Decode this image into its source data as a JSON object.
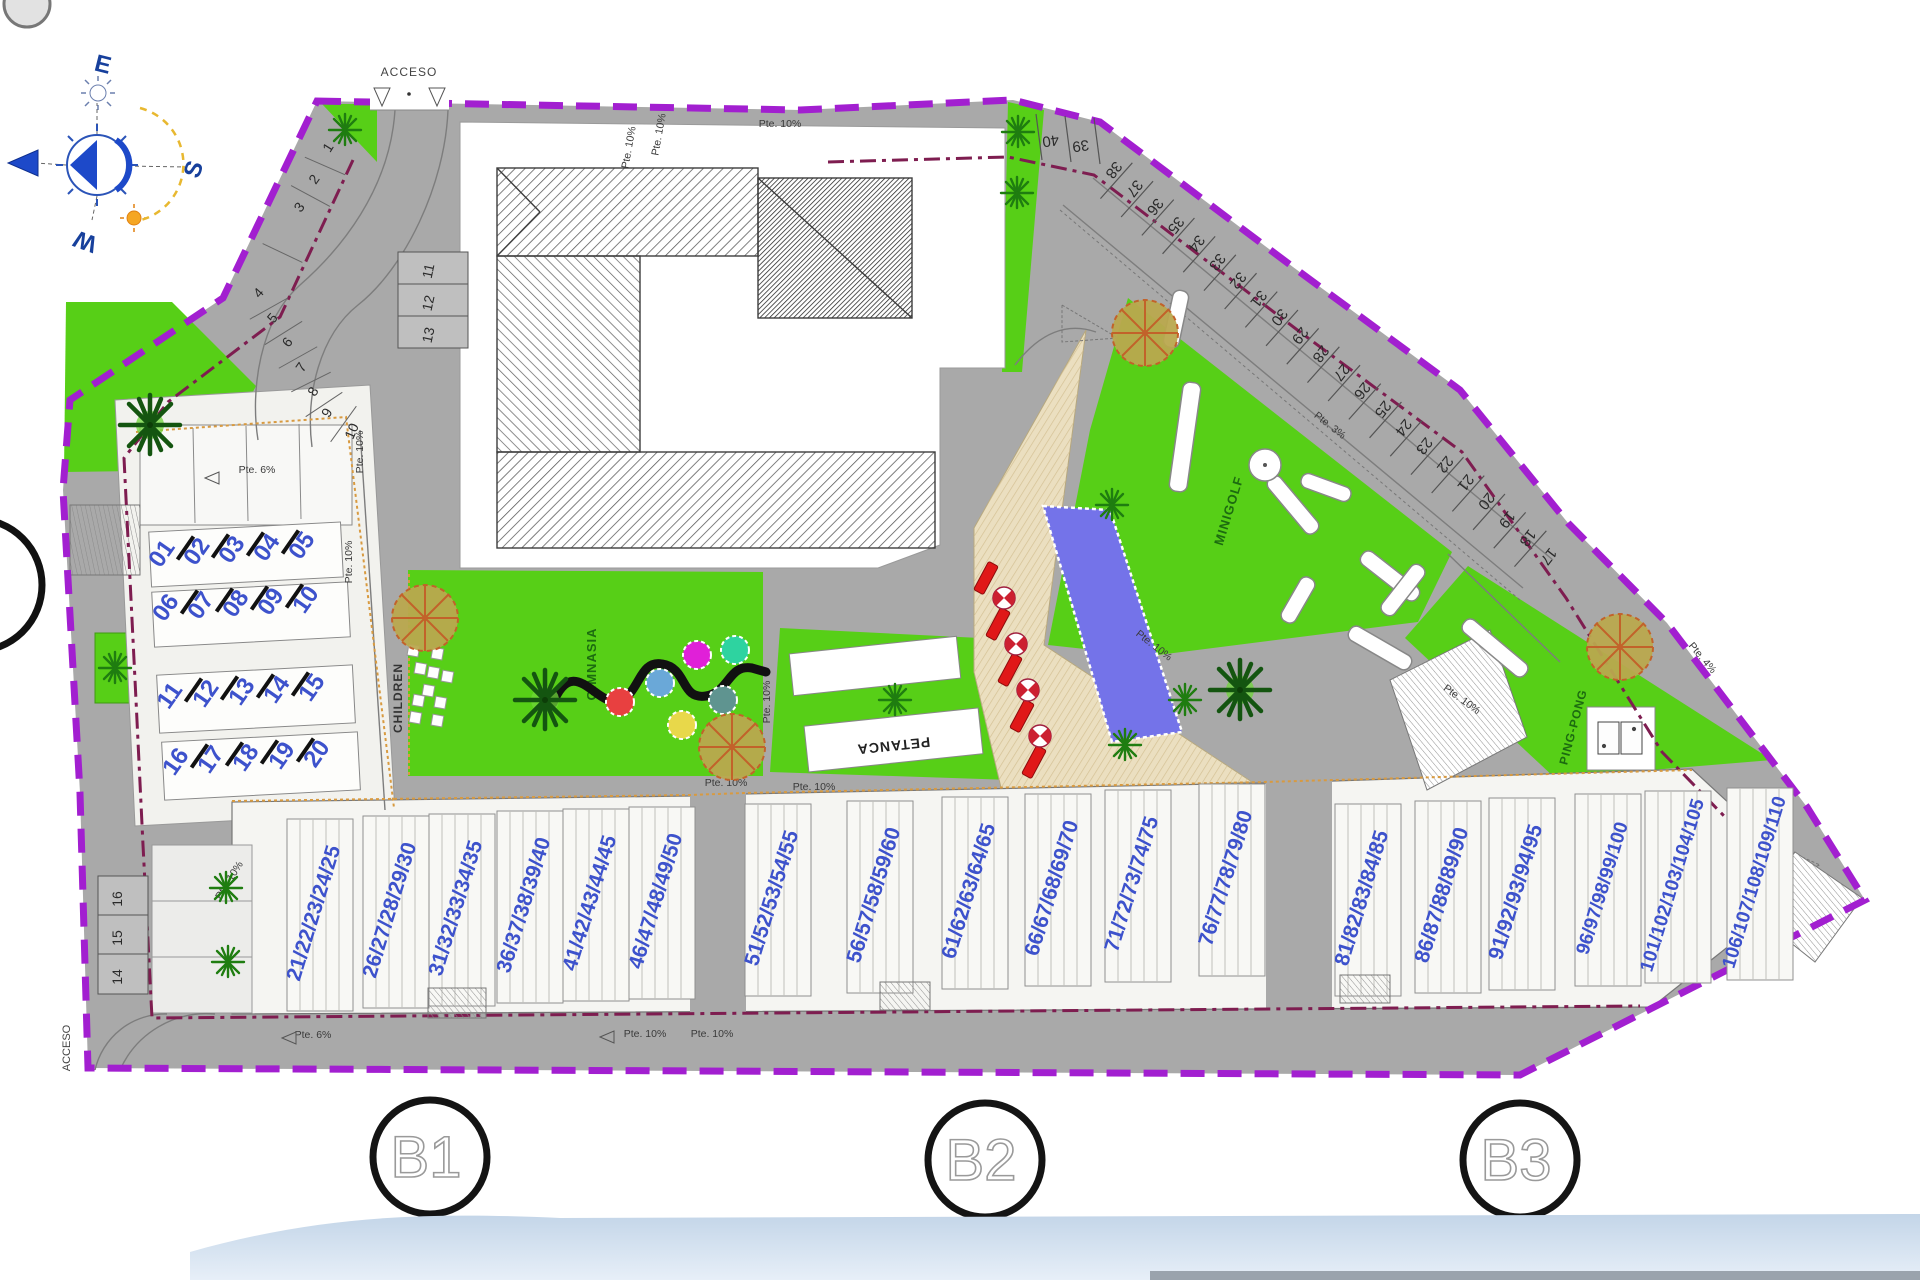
{
  "plan": {
    "access_top": "ACCESO",
    "access_bottom": "ACCESO",
    "compass": {
      "e": "E",
      "s": "S",
      "w": "W"
    },
    "areas": {
      "gym": "GIMNASIA",
      "children": "CHILDREN",
      "petanca": "PETANCA",
      "minigolf": "MINIGOLF",
      "pingpong": "PING-PONG"
    },
    "slopes": {
      "pte10": "Pte. 10%",
      "pte6": "Pte. 6%",
      "pte3": "Pte. 3%",
      "pte4": "Pte. 4%"
    },
    "sections": [
      "B1",
      "B2",
      "B3"
    ],
    "parking": {
      "left_curve": [
        "1",
        "2",
        "3",
        "4",
        "5",
        "6",
        "7",
        "8",
        "9",
        "10"
      ],
      "mid_block": [
        "11",
        "12",
        "13"
      ],
      "left_lower": [
        "16",
        "15",
        "14"
      ],
      "diagonal_top_to_bottom": [
        "38",
        "37",
        "36",
        "35",
        "34",
        "33",
        "32",
        "31",
        "30",
        "29",
        "28",
        "27",
        "26",
        "25",
        "24",
        "23",
        "22",
        "21",
        "20",
        "19",
        "18",
        "17"
      ],
      "upper_pair": [
        "40",
        "39"
      ]
    },
    "terrace_unit_rows": [
      [
        "01",
        "02",
        "03",
        "04",
        "05"
      ],
      [
        "06",
        "07",
        "08",
        "09",
        "10"
      ],
      [
        "11",
        "12",
        "13",
        "14",
        "15"
      ],
      [
        "16",
        "17",
        "18",
        "19",
        "20"
      ]
    ],
    "bottom_unit_groups": [
      [
        "21",
        "22",
        "23",
        "24",
        "25"
      ],
      [
        "26",
        "27",
        "28",
        "29",
        "30"
      ],
      [
        "31",
        "32",
        "33",
        "34",
        "35"
      ],
      [
        "36",
        "37",
        "38",
        "39",
        "40"
      ],
      [
        "41",
        "42",
        "43",
        "44",
        "45"
      ],
      [
        "46",
        "47",
        "48",
        "49",
        "50"
      ],
      [
        "51",
        "52",
        "53",
        "54",
        "55"
      ],
      [
        "56",
        "57",
        "58",
        "59",
        "60"
      ],
      [
        "61",
        "62",
        "63",
        "64",
        "65"
      ],
      [
        "66",
        "67",
        "68",
        "69",
        "70"
      ],
      [
        "71",
        "72",
        "73",
        "74",
        "75"
      ],
      [
        "76",
        "77",
        "78",
        "79",
        "80"
      ],
      [
        "81",
        "82",
        "83",
        "84",
        "85"
      ],
      [
        "86",
        "87",
        "88",
        "89",
        "90"
      ],
      [
        "91",
        "92",
        "93",
        "94",
        "95"
      ],
      [
        "96",
        "97",
        "98",
        "99",
        "100"
      ],
      [
        "101",
        "102",
        "103",
        "104",
        "105"
      ],
      [
        "106",
        "107",
        "108",
        "109",
        "110"
      ]
    ],
    "colors": {
      "boundary": "#A21FD0",
      "inner_boundary": "#7E1D50",
      "lawn": "#57CF17",
      "road": "#A9A9A9",
      "pool": "#7473E9",
      "deck": "#EBDFC0",
      "unit_number": "#3D52CC",
      "building": "#FFFFFF"
    }
  }
}
